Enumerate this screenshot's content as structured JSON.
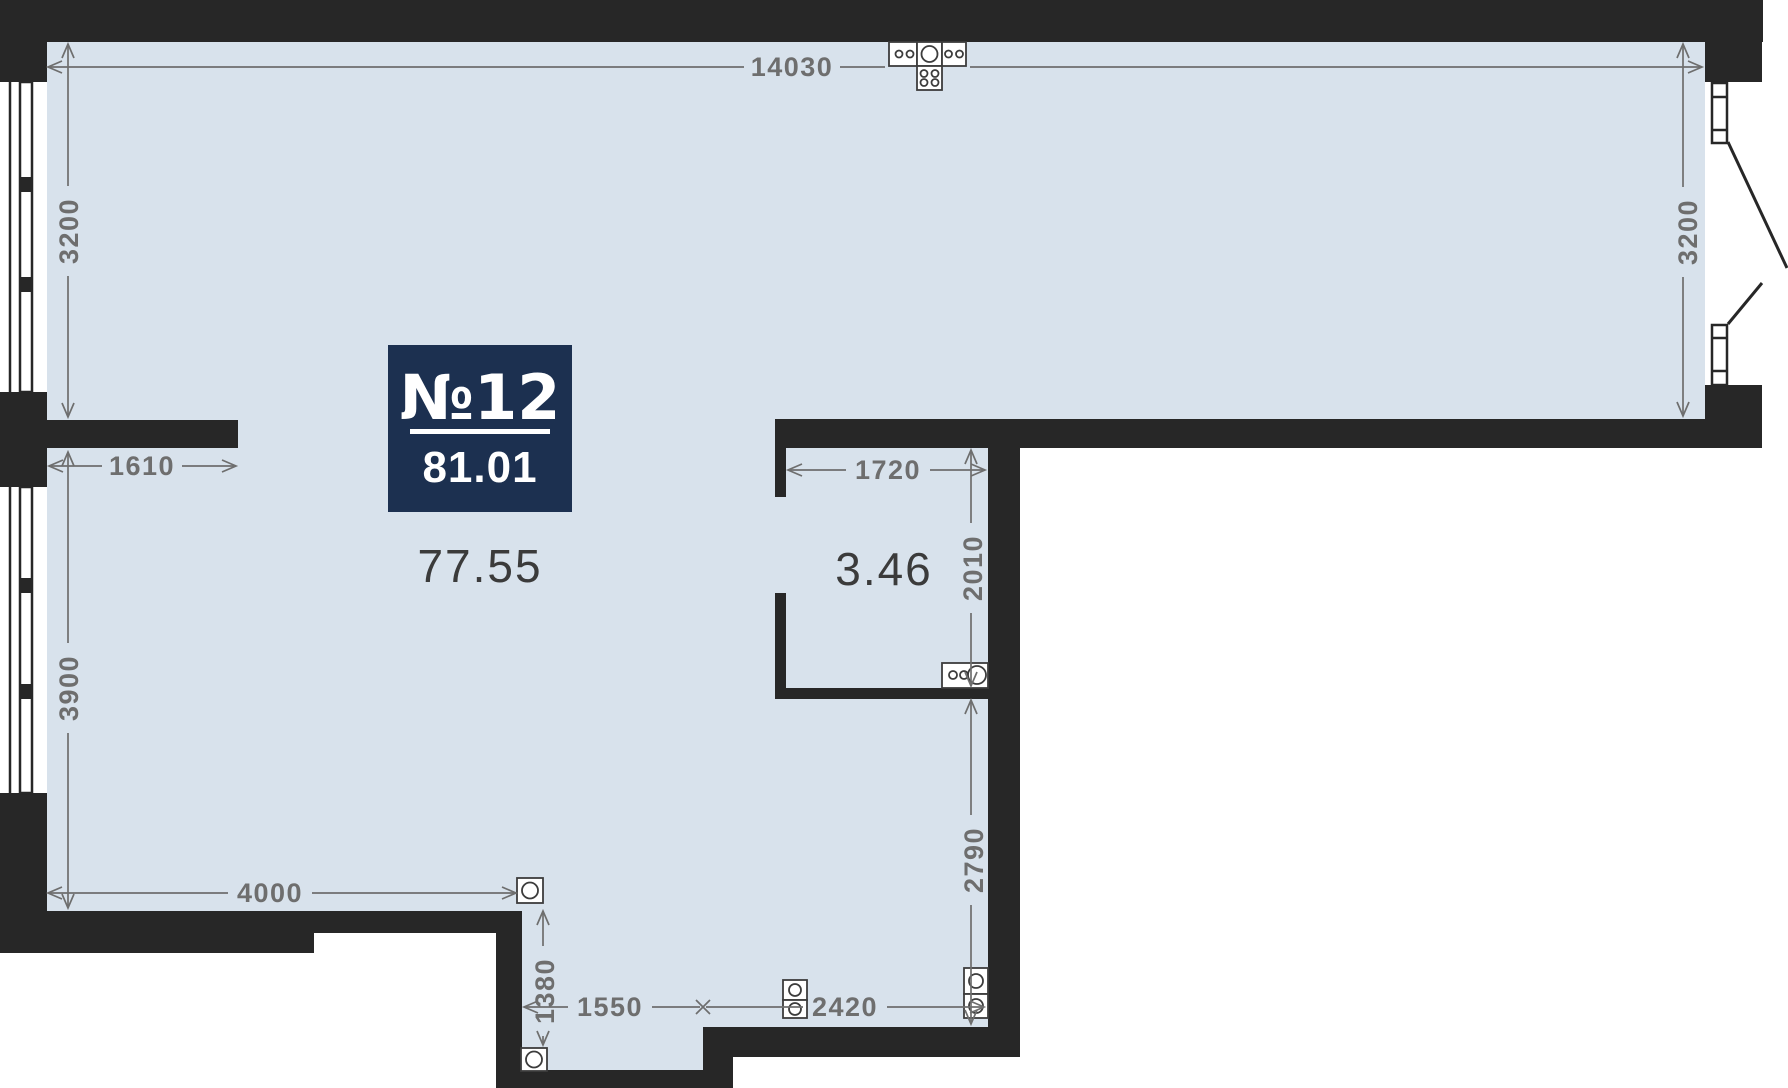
{
  "plan": {
    "badge": {
      "number": "№12",
      "total_area": "81.01"
    },
    "areas": {
      "main_room": "77.55",
      "bathroom": "3.46"
    },
    "dims": {
      "top_width": "14030",
      "left_upper_height": "3200",
      "right_upper_height": "3200",
      "niche_width": "1610",
      "left_lower_height": "3900",
      "bath_width": "1720",
      "bath_height": "2010",
      "below_bath_height": "2790",
      "bottom_left_width": "4000",
      "hall_height": "1380",
      "hall_width": "1550",
      "bottom_right_width": "2420"
    },
    "colors": {
      "wall": "#272727",
      "floor": "#d8e2ec",
      "dim": "#6e6e6e",
      "badge": "#1c3050",
      "area": "#3b3b3b",
      "sym": "#3c3c3c"
    }
  }
}
